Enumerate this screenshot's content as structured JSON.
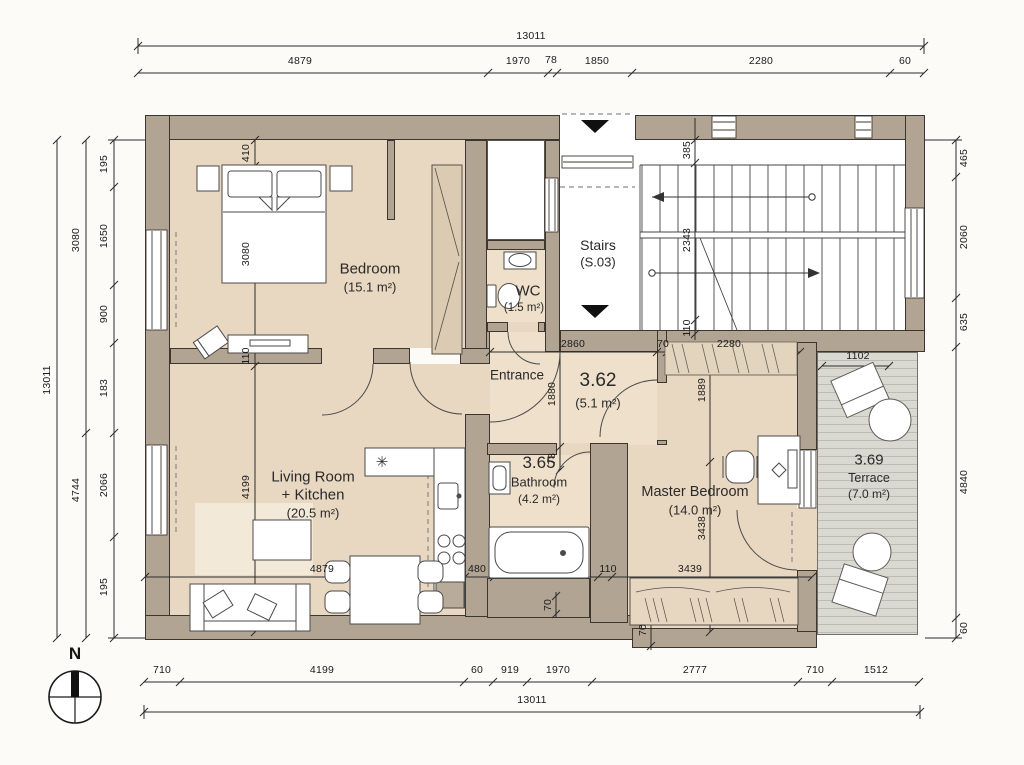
{
  "dims": {
    "top_total": "13011",
    "top": [
      "4879",
      "1970",
      "78",
      "1850",
      "2280",
      "60"
    ],
    "bottom": [
      "710",
      "4199",
      "60",
      "919",
      "1970",
      "2777",
      "710",
      "1512"
    ],
    "bottom_total": "13011",
    "left_outer": "13011",
    "left_mid": [
      "3080",
      "4744"
    ],
    "left_inner": [
      "195",
      "1650",
      "900",
      "183",
      "2066",
      "195"
    ],
    "right": [
      "465",
      "2060",
      "635",
      "4840",
      "60"
    ],
    "interior": {
      "bedroom_top": "410",
      "bedroom_bed": "3080",
      "bedroom_wall": "110",
      "living_height": "4199",
      "living_width": "4879",
      "kitchen": "480",
      "bath_wall": "110",
      "master_width": "3439",
      "master_height": "3438",
      "master_door_side": "1889",
      "entrance_width": "2860",
      "entrance_height": "1880",
      "bath_top": "78",
      "bath_bottom": "70",
      "master_step": "70",
      "wardrobe_gap": "70",
      "wardrobe_width": "2280",
      "stairs_top": "385",
      "stairs_run": "2343",
      "stairs_bottom": "110",
      "terrace_width": "1102"
    }
  },
  "rooms": {
    "bedroom": {
      "name": "Bedroom",
      "area": "(15.1 m²)"
    },
    "living": {
      "name1": "Living Room",
      "name2": "+ Kitchen",
      "area": "(20.5 m²)"
    },
    "wc": {
      "name": "WC",
      "area": "(1.5 m²)"
    },
    "stairs": {
      "name": "Stairs",
      "code": "(S.03)"
    },
    "entrance": {
      "name": "Entrance",
      "number": "3.62",
      "area": "(5.1 m²)"
    },
    "bathroom": {
      "number": "3.65",
      "name": "Bathroom",
      "area": "(4.2 m²)"
    },
    "master": {
      "name": "Master Bedroom",
      "area": "(14.0 m²)"
    },
    "terrace": {
      "number": "3.69",
      "name": "Terrace",
      "area": "(7.0 m²)"
    }
  },
  "compass": {
    "label": "N"
  },
  "kitchen": {
    "hob_symbol": "✳"
  },
  "colors": {
    "wall": "#b2a493",
    "floor": "#e9d8c1",
    "floor2": "#eee0cb",
    "terrace": "#d9d9d2",
    "line": "#3c362f"
  }
}
